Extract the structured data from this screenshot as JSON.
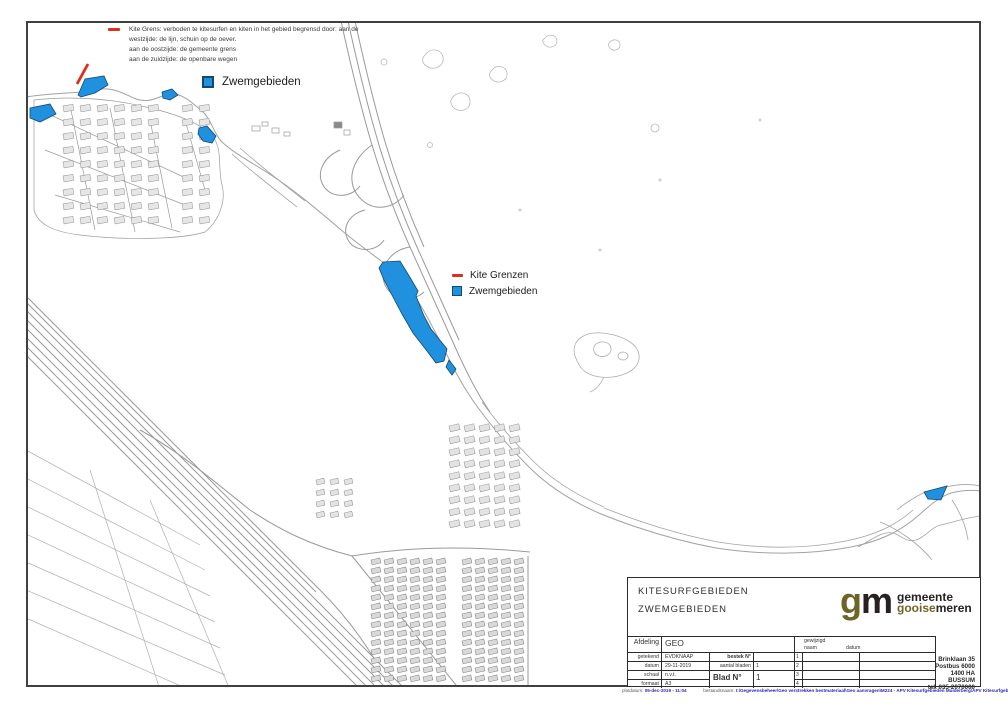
{
  "colors": {
    "swim_fill": "#2091df",
    "swim_border": "#14486f",
    "kite_red": "#dd2f1e",
    "linework": "#a6a6a6",
    "frame": "#404040",
    "logo_olive": "#6f6428",
    "logo_dark": "#272122",
    "footer_blue": "#2a2ab4"
  },
  "legend_note": {
    "lines": [
      "Kite Grens: verboden te kitesurfen en kiten in het gebied begrensd door: aan de",
      "westzijde: de lijn, schuin op de oever.",
      "aan de oostzijde: de gemeente grens",
      "aan de zuidzijde: de openbare wegen"
    ]
  },
  "legend_top": {
    "zwem_label": "Zwemgebieden"
  },
  "legend_mid": {
    "kite_label": "Kite Grenzen",
    "zwem_label": "Zwemgebieden"
  },
  "title_block": {
    "title_line1": "KITESURFGEBIEDEN",
    "title_line2": "ZWEMGEBIEDEN",
    "logo": {
      "g": "g",
      "m": "m",
      "line1": "gemeente",
      "line2_accent": "gooise",
      "line2_rest": "meren"
    },
    "table": {
      "afdeling_label": "Afdeling",
      "afdeling_value": "GEO",
      "rows": [
        {
          "label": "getekend",
          "value": "EVDKNAAP"
        },
        {
          "label": "datum",
          "value": "29-11-2019"
        },
        {
          "label": "schaal",
          "value": "n.v.t."
        },
        {
          "label": "formaat",
          "value": "A3"
        }
      ],
      "bestek_label": "bestek N°",
      "aantal_label": "aantal bladen",
      "aantal_value": "1",
      "blad_label": "Blad N°",
      "blad_value": "1",
      "gewijzigd_label": "gewijzigd",
      "naam_label": "naam",
      "datum_label": "datum",
      "row_numbers": [
        "1",
        "2",
        "3",
        "4"
      ]
    },
    "address_lines": [
      "Brinklaan 35",
      "Postbus 6000",
      "1400 HA BUSSUM",
      "tel. 035-2070000"
    ]
  },
  "footer": {
    "plot_label": "plotdatum:",
    "plot_value": "05-dec-2019 - 11:04",
    "file_label": "bestandsnaam:",
    "file_value": "I:\\Gegevensbeheer\\Geo verstrekken bestmateriaal\\Geo aanvragen\\M224 - APV Kitesurfgebieden Muiderberg\\APV Kitesurfgebieden Muiderberg.dwg"
  },
  "map": {
    "swim_areas": [
      [
        [
          30,
          108
        ],
        [
          50,
          104
        ],
        [
          56,
          114
        ],
        [
          40,
          122
        ],
        [
          30,
          118
        ]
      ],
      [
        [
          78,
          95
        ],
        [
          85,
          79
        ],
        [
          104,
          76
        ],
        [
          108,
          85
        ],
        [
          95,
          93
        ],
        [
          81,
          97
        ]
      ],
      [
        [
          162,
          92
        ],
        [
          172,
          89
        ],
        [
          178,
          95
        ],
        [
          170,
          100
        ],
        [
          163,
          98
        ]
      ],
      [
        [
          199,
          128
        ],
        [
          207,
          126
        ],
        [
          216,
          136
        ],
        [
          212,
          143
        ],
        [
          203,
          141
        ],
        [
          198,
          134
        ]
      ],
      [
        [
          383,
          262
        ],
        [
          400,
          261
        ],
        [
          411,
          279
        ],
        [
          418,
          291
        ],
        [
          416,
          296
        ],
        [
          424,
          316
        ],
        [
          431,
          329
        ],
        [
          447,
          349
        ],
        [
          444,
          361
        ],
        [
          436,
          363
        ],
        [
          427,
          351
        ],
        [
          413,
          333
        ],
        [
          402,
          314
        ],
        [
          393,
          297
        ],
        [
          384,
          280
        ],
        [
          379,
          268
        ]
      ],
      [
        [
          449,
          360
        ],
        [
          456,
          369
        ],
        [
          452,
          375
        ],
        [
          446,
          367
        ]
      ],
      [
        [
          924,
          492
        ],
        [
          947,
          486
        ],
        [
          941,
          500
        ],
        [
          928,
          499
        ]
      ]
    ],
    "kite_line": [
      [
        77,
        84
      ],
      [
        88,
        64
      ]
    ]
  }
}
